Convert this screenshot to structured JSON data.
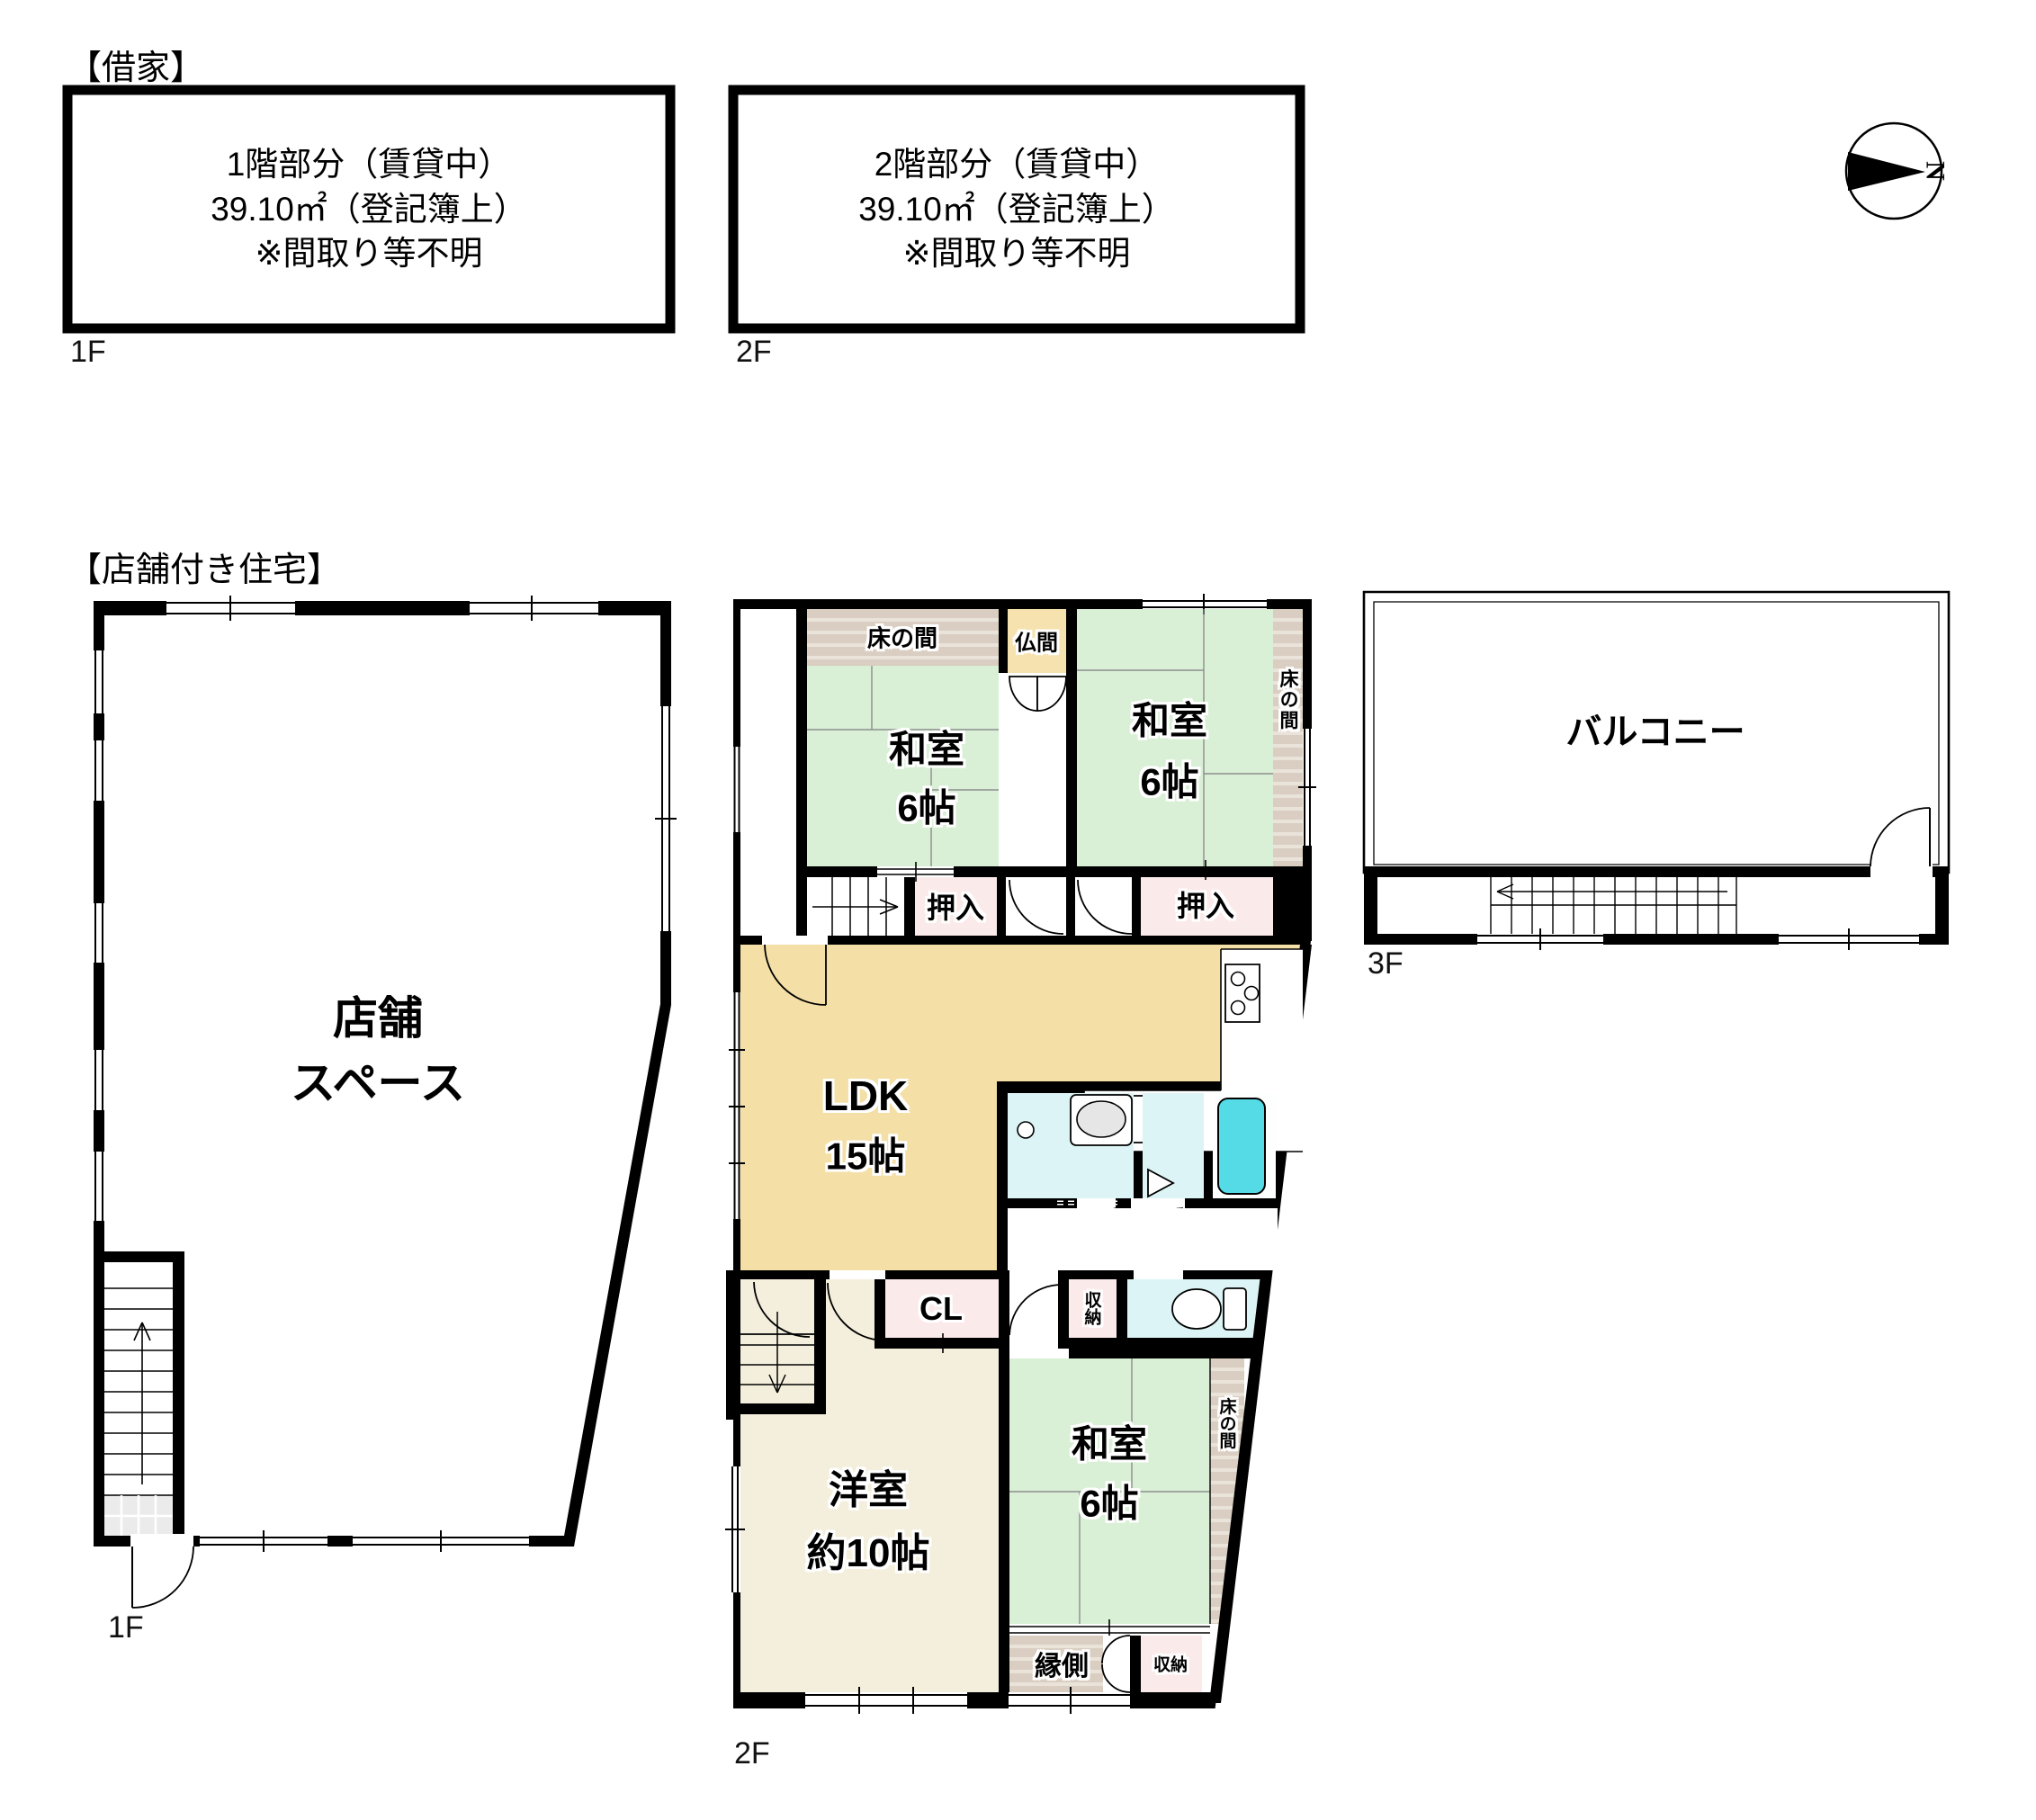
{
  "rental_section": {
    "title": "【借家】",
    "units": [
      {
        "floor_label": "1F",
        "line1": "1階部分（賃貸中）",
        "line2": "39.10㎡（登記簿上）",
        "line3": "※間取り等不明"
      },
      {
        "floor_label": "2F",
        "line1": "2階部分（賃貸中）",
        "line2": "39.10㎡（登記簿上）",
        "line3": "※間取り等不明"
      }
    ]
  },
  "compass": {
    "north_label": "N"
  },
  "shop_house_section": {
    "title": "【店舗付き住宅】",
    "floor_1f": {
      "floor_label": "1F",
      "shop_space_line1": "店舗",
      "shop_space_line2": "スペース"
    },
    "floor_2f": {
      "floor_label": "2F",
      "tokonoma_top": "床の間",
      "butsuma": "仏間",
      "washitsu_nw_name": "和室",
      "washitsu_nw_size": "6帖",
      "washitsu_ne_name": "和室",
      "washitsu_ne_size": "6帖",
      "tokonoma_right": "床の間",
      "oshiire_left": "押入",
      "oshiire_right": "押入",
      "ldk_name": "LDK",
      "ldk_size": "15帖",
      "closet": "CL",
      "storage_mid": "収納",
      "washitsu_s_name": "和室",
      "washitsu_s_size": "6帖",
      "tokonoma_south": "床の間",
      "yoshitsu_name": "洋室",
      "yoshitsu_size": "約10帖",
      "engawa": "縁側",
      "storage_south": "収納"
    },
    "floor_3f": {
      "floor_label": "3F",
      "balcony": "バルコニー"
    }
  },
  "colors": {
    "tatami": "#d9f0d6",
    "tokonoma_base": "#d9cec1",
    "tokonoma_stripe": "#eae3d9",
    "butsuma": "#f6e2ae",
    "closet_pink": "#fbeaea",
    "ldk": "#f4dfa6",
    "bath_cyan": "#dcf4f5",
    "tub": "#55dbe6",
    "yoshitsu": "#f4efdd",
    "wall": "#000000",
    "tile": "#ebebeb"
  }
}
